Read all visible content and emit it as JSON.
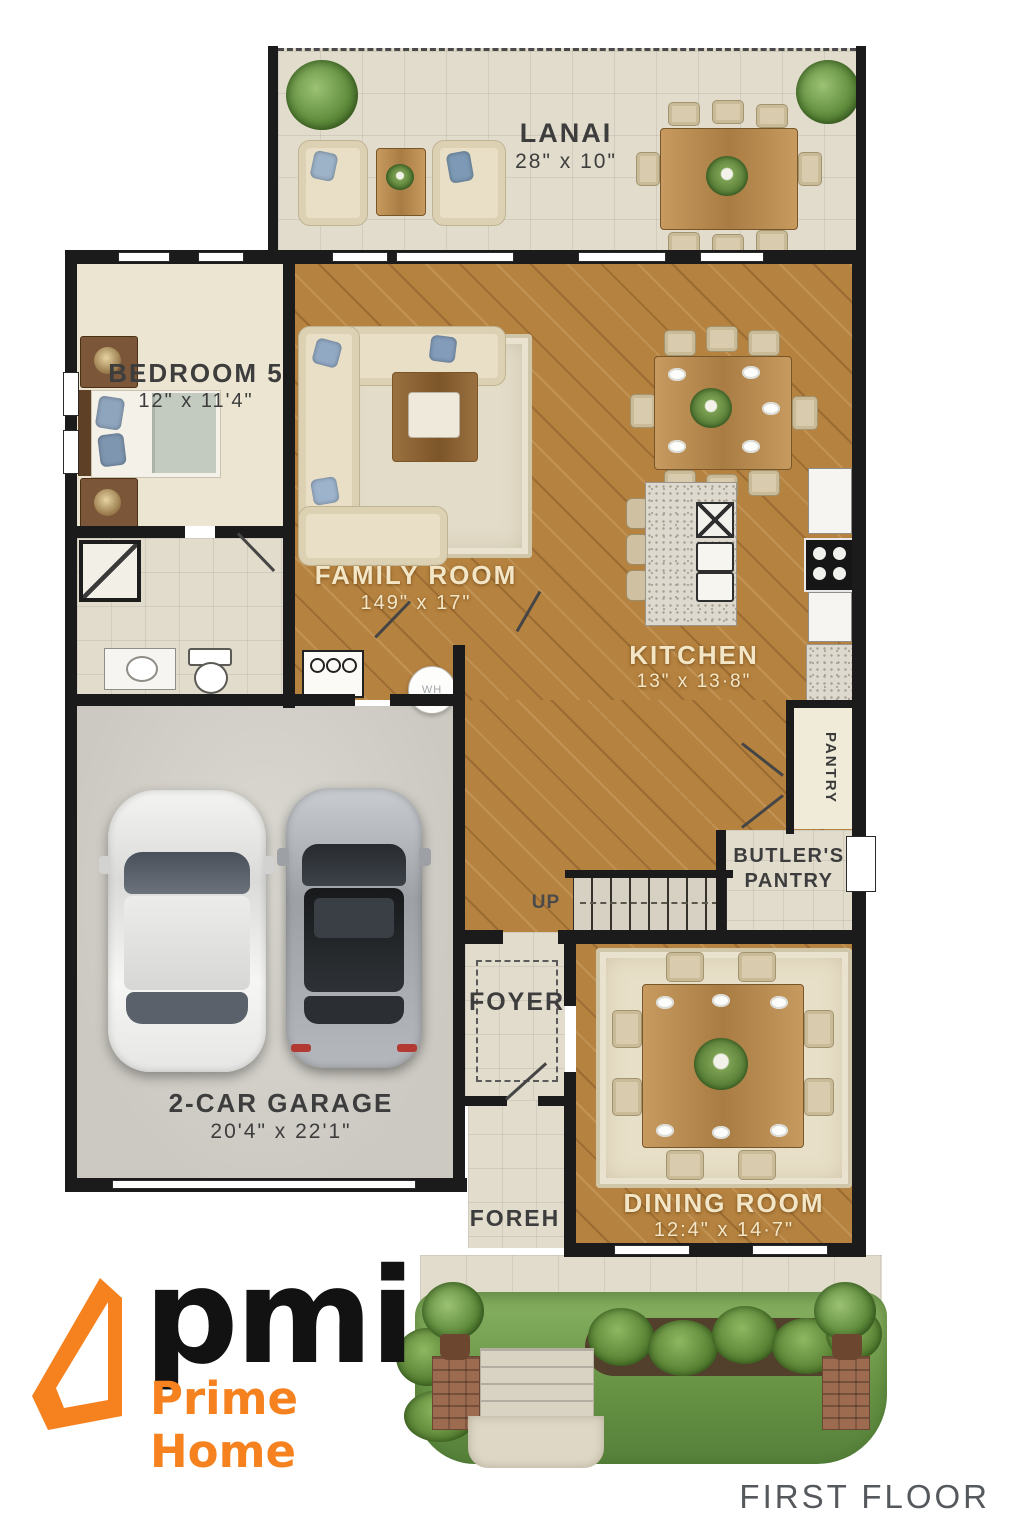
{
  "page": {
    "floor_label": "FIRST FLOOR"
  },
  "branding": {
    "logo_text": "pmi",
    "logo_subtext": "Prime Home"
  },
  "rooms": {
    "lanai": {
      "name": "LANAI",
      "dims": "28\" x 10\""
    },
    "bedroom5": {
      "name": "BEDROOM 5",
      "dims": "12\" x 11'4\""
    },
    "family_room": {
      "name": "FAMILY ROOM",
      "dims": "149\" x 17\""
    },
    "kitchen": {
      "name": "KITCHEN",
      "dims": "13\" x 13·8\""
    },
    "butlers_pantry": {
      "line1": "BUTLER'S",
      "line2": "PANTRY"
    },
    "pantry": {
      "name": "PANTRY"
    },
    "stairs": {
      "label": "UP"
    },
    "foyer": {
      "name": "FOYER"
    },
    "garage": {
      "name": "2-CAR GARAGE",
      "dims": "20'4\" x 22'1\""
    },
    "porch": {
      "name": "FOREH"
    },
    "dining_room": {
      "name": "DINING ROOM",
      "dims": "12:4\" x 14·7\""
    }
  },
  "annotations": {
    "water_heater": "WH"
  },
  "colors": {
    "wall": "#1b1b1b",
    "wood_floor": "#b5823f",
    "tile_floor": "#e2dccd",
    "logo_orange": "#f5821f",
    "footer_gray": "#55595d"
  }
}
